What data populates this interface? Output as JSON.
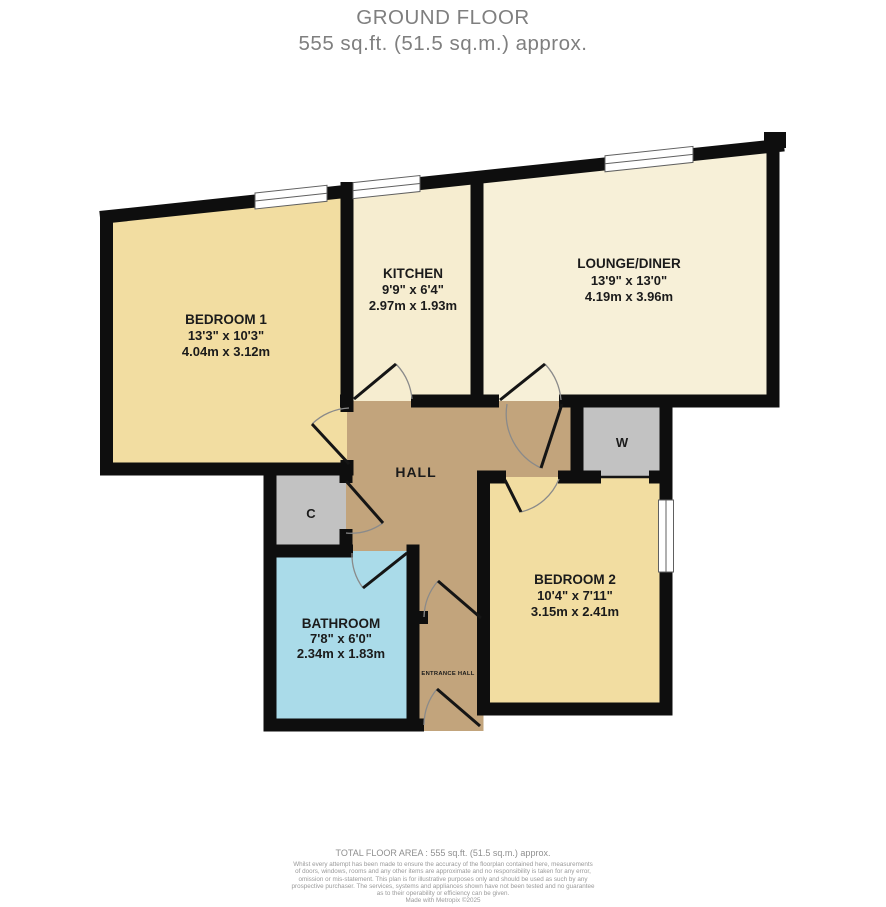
{
  "title": {
    "line1": "GROUND FLOOR",
    "line2": "555 sq.ft. (51.5 sq.m.) approx."
  },
  "rooms": {
    "bedroom1": {
      "name": "BEDROOM 1",
      "imperial": "13'3\"  x 10'3\"",
      "metric": "4.04m  x 3.12m"
    },
    "kitchen": {
      "name": "KITCHEN",
      "imperial": "9'9\"  x 6'4\"",
      "metric": "2.97m  x 1.93m"
    },
    "lounge": {
      "name": "LOUNGE/DINER",
      "imperial": "13'9\"  x 13'0\"",
      "metric": "4.19m  x 3.96m"
    },
    "bedroom2": {
      "name": "BEDROOM 2",
      "imperial": "10'4\"  x 7'11\"",
      "metric": "3.15m  x 2.41m"
    },
    "bathroom": {
      "name": "BATHROOM",
      "imperial": "7'8\"  x 6'0\"",
      "metric": "2.34m  x 1.83m"
    },
    "hall": {
      "name": "HALL"
    },
    "entrance_hall": {
      "name": "ENTRANCE HALL"
    },
    "wardrobe": {
      "name": "W"
    },
    "cupboard": {
      "name": "C"
    }
  },
  "footer": {
    "total": "TOTAL FLOOR AREA : 555 sq.ft. (51.5 sq.m.) approx.",
    "disclaimer": [
      "Whilst every attempt has been made to ensure the accuracy of the floorplan contained here, measurements",
      "of doors, windows, rooms and any other items are approximate and no responsibility is taken for any error,",
      "omission or mis-statement. This plan is for illustrative purposes only and should be used as such by any",
      "prospective purchaser. The services, systems and appliances shown have not been tested and no guarantee",
      "as to their operability or efficiency can be given.",
      "Made with Metropix ©2025"
    ]
  },
  "colors": {
    "wall": "#0e0e0e",
    "bedroom": "#f2dda1",
    "kitchen": "#f6edd0",
    "lounge": "#f7f0d8",
    "hall": "#c2a47c",
    "bathroom": "#aadbe9",
    "closet": "#c2c2c2",
    "title_text": "#7f7f7f"
  }
}
